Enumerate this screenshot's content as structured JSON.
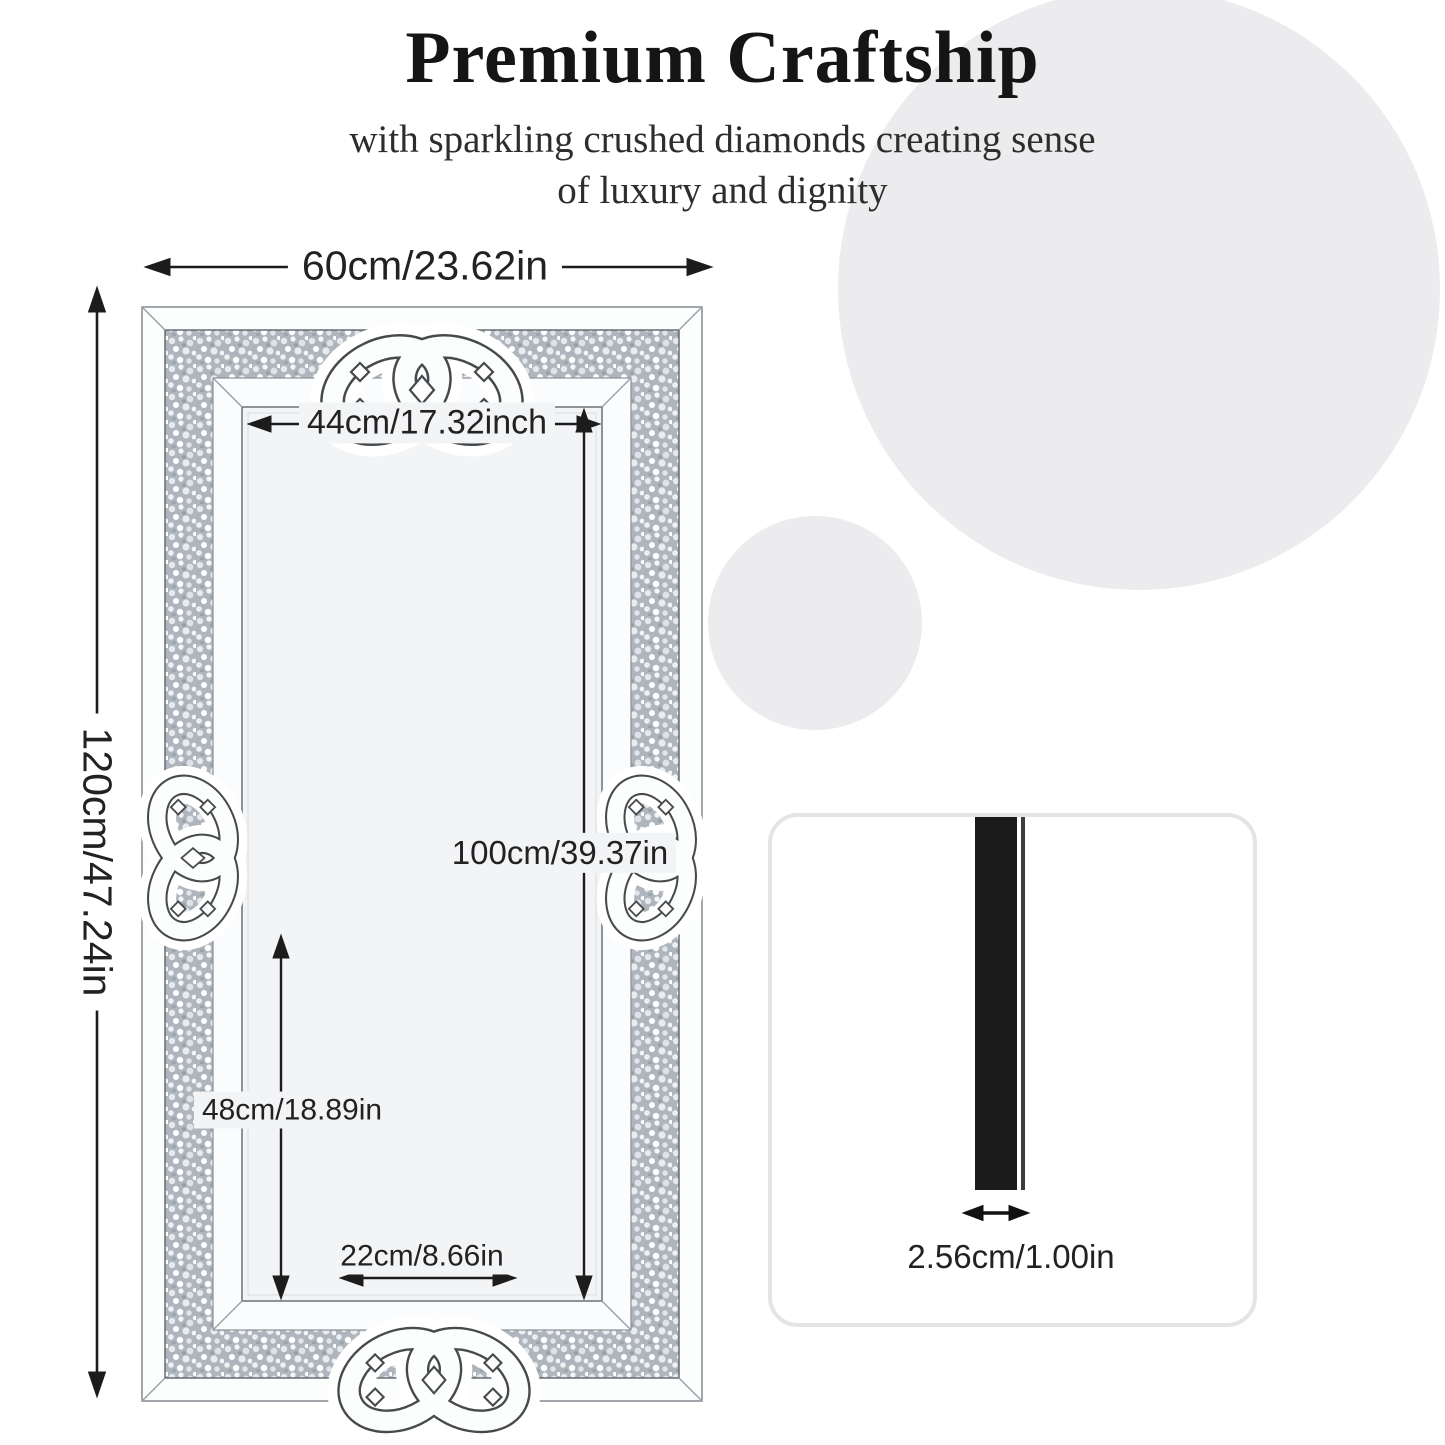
{
  "header": {
    "title": "Premium Craftship",
    "subtitle1": "with sparkling crushed diamonds creating sense",
    "subtitle2": "of luxury and dignity"
  },
  "mirror": {
    "width_label": "60cm/23.62in",
    "height_label": "120cm/47.24in",
    "inner_width_label": "44cm/17.32inch",
    "inner_height_label": "100cm/39.37in",
    "lower_height_label": "48cm/18.89in",
    "bottom_width_label": "22cm/8.66in"
  },
  "thickness": {
    "label": "2.56cm/1.00in"
  },
  "colors": {
    "background_circle": "#ececee",
    "sparkle_band_base": "#aeb5bc",
    "mirror_glass": "#f3f4f6",
    "dimension_line": "#1c1c1c",
    "side_profile_bar": "#1b1b1b",
    "card_border": "#e4e4e6"
  }
}
